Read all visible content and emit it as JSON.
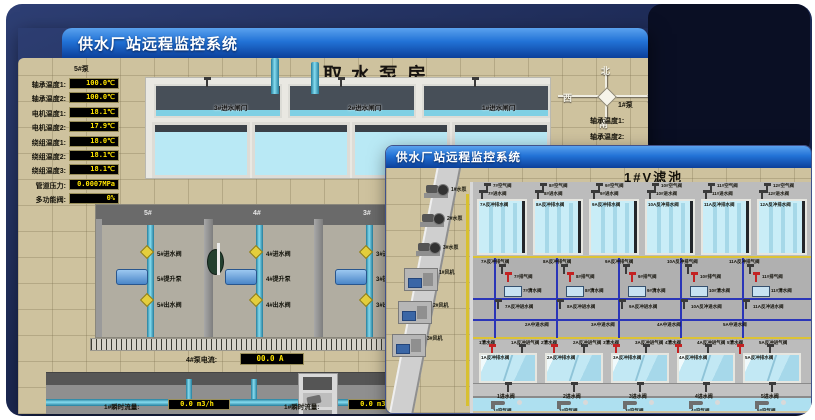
{
  "back_window": {
    "title": "供水厂站远程监控系统",
    "scene_title": "取水泵房",
    "pump_panel": {
      "header": "5#泵",
      "rows": [
        {
          "label": "轴承温度1:",
          "value": "100.0℃"
        },
        {
          "label": "轴承温度2:",
          "value": "100.0℃"
        },
        {
          "label": "电机温度1:",
          "value": "18.1℃"
        },
        {
          "label": "电机温度2:",
          "value": "17.9℃"
        },
        {
          "label": "绕组温度1:",
          "value": "18.0℃"
        },
        {
          "label": "绕组温度2:",
          "value": "18.1℃"
        },
        {
          "label": "绕组温度3:",
          "value": "18.1℃"
        },
        {
          "label": "管道压力:",
          "value": "0.0007MPa"
        },
        {
          "label": "多功能阀:",
          "value": "0%"
        }
      ]
    },
    "gates": [
      "3#进水闸门",
      "2#进水闸门",
      "1#进水闸门"
    ],
    "bays": [
      {
        "no": "5#",
        "valve_in": "5#进水阀",
        "pump": "5#提升泵",
        "valve_out": "5#出水阀"
      },
      {
        "no": "4#",
        "valve_in": "4#进水阀",
        "pump": "4#提升泵",
        "valve_out": "4#出水阀"
      },
      {
        "no": "3#",
        "valve_in": "3#进水阀",
        "pump": "3#提升泵",
        "valve_out": "3#出水阀"
      },
      {
        "no": "2#"
      }
    ],
    "currents": [
      {
        "label": "4#泵电流:",
        "value": "00.0 A"
      },
      {
        "label": "2#泵电流:",
        "value": ""
      }
    ],
    "flows": [
      {
        "label": "1#瞬时流量:",
        "value": "0.0 m3/h"
      },
      {
        "label": "1#瞬时流量:",
        "value": "0.0 m3/h"
      }
    ],
    "compass": {
      "north": "北",
      "south": "南",
      "west": "西",
      "east": "东"
    },
    "side_panel": {
      "header": "1#泵",
      "labels": [
        "轴承温度1:",
        "轴承温度2:"
      ]
    }
  },
  "front_window": {
    "title": "供水厂站远程监控系统",
    "scene_title": "1#V滤池",
    "left_units": {
      "pumps": [
        "1#水泵",
        "2#水泵",
        "3#水泵"
      ],
      "fans": [
        "1#风机",
        "2#风机",
        "3#风机"
      ]
    },
    "back_cells": [
      {
        "air": "7#空气阀",
        "inlet": "7#进水阀",
        "drain": "7A反冲排水阀"
      },
      {
        "air": "8#空气阀",
        "inlet": "8#进水阀",
        "drain": "8A反冲排水阀"
      },
      {
        "air": "9#空气阀",
        "inlet": "9#进水阀",
        "drain": "9A反冲排水阀"
      },
      {
        "air": "10#空气阀",
        "inlet": "10#进水阀",
        "drain": "10A反冲排水阀"
      },
      {
        "air": "11#空气阀",
        "inlet": "11#进水阀",
        "drain": "11A反冲排水阀"
      },
      {
        "air": "12#空气阀",
        "inlet": "12#进水阀",
        "drain": "12A反冲排水阀"
      }
    ],
    "gallery_columns": [
      {
        "backwash_air": "7A反冲排气阀",
        "air": "7#排气阀",
        "clean": "7#清水阀",
        "backwash_in": "7A反冲进水阀"
      },
      {
        "backwash_air": "8A反冲排气阀",
        "air": "8#排气阀",
        "clean": "8#清水阀",
        "backwash_in": "8A反冲进水阀"
      },
      {
        "backwash_air": "9A反冲排气阀",
        "air": "9#排气阀",
        "clean": "9#清水阀",
        "backwash_in": "9A反冲进水阀"
      },
      {
        "backwash_air": "10A反冲排气阀",
        "air": "10#排气阀",
        "clean": "10#清水阀",
        "backwash_in": "10A反冲进水阀"
      },
      {
        "backwash_air": "11A反冲排气阀",
        "air": "11#排气阀",
        "clean": "11#清水阀",
        "backwash_in": "11A反冲进水阀"
      }
    ],
    "mid_pipe_labels": [
      "2A中进水阀",
      "3A中进水阀",
      "4A中进水阀",
      "5A中进水阀"
    ],
    "lower_columns": [
      {
        "clean": "1清水阀",
        "backwash_gas": "1A反冲进气阀"
      },
      {
        "clean": "2清水阀",
        "backwash_gas": "2A反冲进气阀"
      },
      {
        "clean": "3清水阀",
        "backwash_gas": "3A反冲进气阀"
      },
      {
        "clean": "4清水阀",
        "backwash_gas": "4A反冲进气阀"
      },
      {
        "clean": "5清水阀",
        "backwash_gas": "5A反冲进气阀"
      }
    ],
    "front_cells": [
      {
        "drain": "1A反冲排水阀",
        "inlet": "1进水阀",
        "air": "1#空气阀"
      },
      {
        "drain": "2A反冲排水阀",
        "inlet": "2进水阀",
        "air": "2#空气阀"
      },
      {
        "drain": "3A反冲排水阀",
        "inlet": "3进水阀",
        "air": "3#空气阀"
      },
      {
        "drain": "4A反冲排水阀",
        "inlet": "4进水阀",
        "air": "4#空气阀"
      },
      {
        "drain": "5A反冲排水阀",
        "inlet": "5进水阀",
        "air": "5#空气阀"
      }
    ]
  }
}
